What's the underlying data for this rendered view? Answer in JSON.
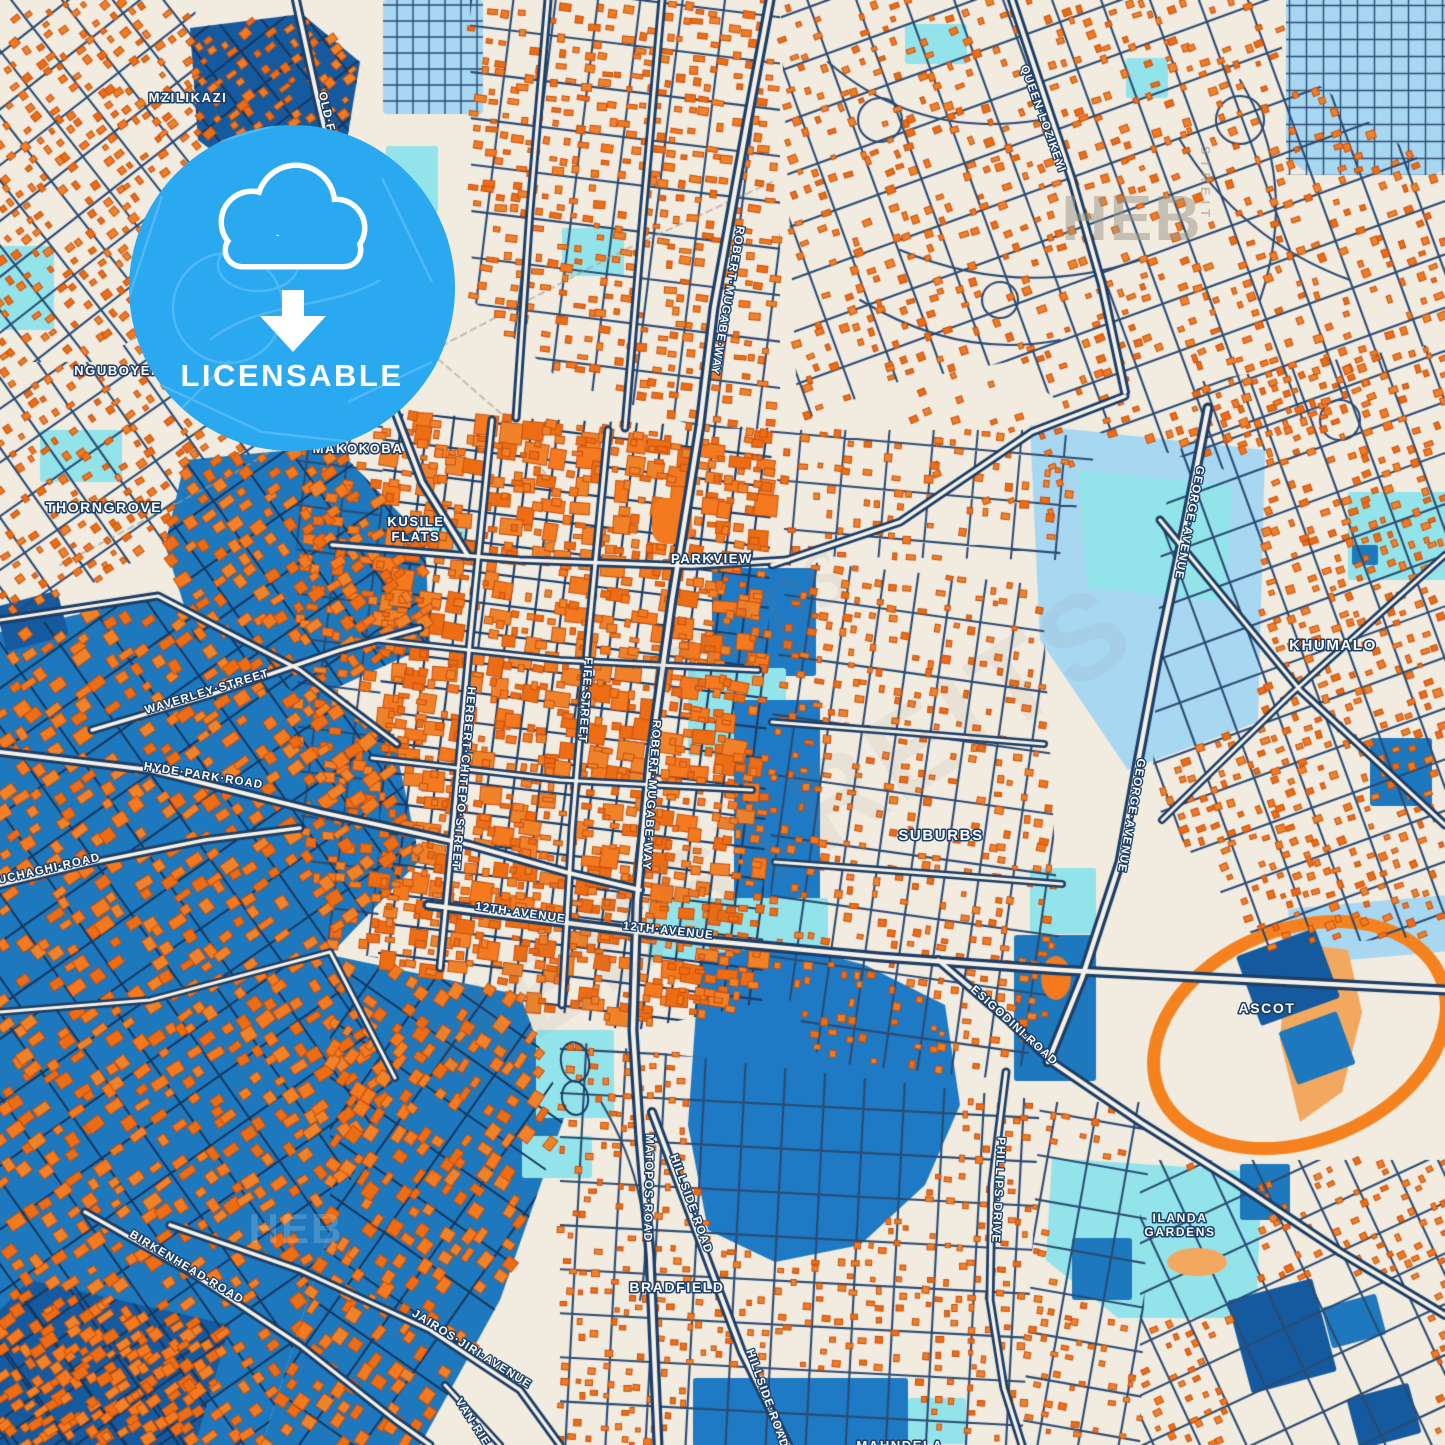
{
  "badge": {
    "label": "LICENSABLE",
    "inner_place_line1": "BARBOUR",
    "inner_place_line2": "FIELDS",
    "icon": "cloud-download-icon",
    "color": "#2aa9f1",
    "cx": 292,
    "cy": 288,
    "r": 163
  },
  "colors": {
    "background": "#f1ebe0",
    "building_fill": "#f4791f",
    "building_alt": "#ed6d15",
    "building_alt2": "#f0832a",
    "building_edge": "#c7500f",
    "industrial_blue": "#1d78bd",
    "dark_blue_zone": "#155a9e",
    "lake_blue": "#1e7ac4",
    "park_cyan": "#93e4ea",
    "pale_blue": "#a8d7f2",
    "road_navy": "#1c3e67",
    "road_fill": "#f6f1e6",
    "minor_road": "#2b4b73",
    "minor_road_dark": "#16375f",
    "racetrack_orange": "#f5821f",
    "sand_orange": "#f3a860",
    "railway_gray": "#a89f8f",
    "badge_blue": "#2aa9f1",
    "label_white": "#ffffff",
    "watermark_gray": "#9c9588"
  },
  "place_labels": [
    {
      "text": "MZILIKAZI",
      "x": 188,
      "y": 102,
      "size": 13
    },
    {
      "text": "NGUBOYENJA",
      "x": 128,
      "y": 375,
      "size": 13
    },
    {
      "text": "THORNGROVE",
      "x": 104,
      "y": 512,
      "size": 14
    },
    {
      "text": "MAKOKOBA",
      "x": 358,
      "y": 453,
      "size": 13
    },
    {
      "text": "KUSILE",
      "x": 416,
      "y": 526,
      "size": 13,
      "line2": "FLATS"
    },
    {
      "text": "PARKVIEW",
      "x": 712,
      "y": 563,
      "size": 13
    },
    {
      "text": "SUBURBS",
      "x": 941,
      "y": 840,
      "size": 15
    },
    {
      "text": "KHUMALO",
      "x": 1333,
      "y": 650,
      "size": 15
    },
    {
      "text": "ASCOT",
      "x": 1267,
      "y": 1013,
      "size": 14
    },
    {
      "text": "ILANDA",
      "x": 1180,
      "y": 1222,
      "size": 12,
      "line2": "GARDENS"
    },
    {
      "text": "BRADFIELD",
      "x": 677,
      "y": 1292,
      "size": 14
    },
    {
      "text": "MAHNDELA",
      "x": 900,
      "y": 1450,
      "size": 13
    }
  ],
  "street_labels": [
    {
      "text": "OLD·FALLS·ROAD",
      "x": 332,
      "y": 150,
      "rot": 77
    },
    {
      "text": "QUEEN·LOZIKEYI",
      "x": 1040,
      "y": 120,
      "rot": 70
    },
    {
      "text": "ROBERT·MUGABE·WAY",
      "x": 724,
      "y": 300,
      "rot": 100
    },
    {
      "text": "ROBERT·MUGABE·WAY",
      "x": 648,
      "y": 795,
      "rot": 94
    },
    {
      "text": "FIFE·STREET",
      "x": 582,
      "y": 700,
      "rot": 94
    },
    {
      "text": "HERBERT·CHITEPO·STREET",
      "x": 460,
      "y": 778,
      "rot": 95
    },
    {
      "text": "GEORGE·AVENUE",
      "x": 1186,
      "y": 522,
      "rot": 101
    },
    {
      "text": "GEORGE·AVENUE",
      "x": 1128,
      "y": 815,
      "rot": 100
    },
    {
      "text": "WAVERLEY·STREET",
      "x": 208,
      "y": 695,
      "rot": -17
    },
    {
      "text": "HYDE·PARK·ROAD",
      "x": 203,
      "y": 779,
      "rot": 9
    },
    {
      "text": "UCHAGHI·ROAD",
      "x": 50,
      "y": 872,
      "rot": -13
    },
    {
      "text": "12TH·AVENUE",
      "x": 520,
      "y": 916,
      "rot": 8
    },
    {
      "text": "12TH·AVENUE",
      "x": 668,
      "y": 934,
      "rot": 6
    },
    {
      "text": "ESIGODINI·ROAD",
      "x": 1012,
      "y": 1028,
      "rot": 42
    },
    {
      "text": "PHILLIPS·DRIVE",
      "x": 995,
      "y": 1190,
      "rot": 93
    },
    {
      "text": "MATOPOS·ROAD",
      "x": 645,
      "y": 1188,
      "rot": 91
    },
    {
      "text": "HILLSIDE·ROAD",
      "x": 688,
      "y": 1205,
      "rot": 70
    },
    {
      "text": "HILLSIDE·ROAD",
      "x": 764,
      "y": 1400,
      "rot": 70
    },
    {
      "text": "JAIROS·JIRI·AVENUE",
      "x": 470,
      "y": 1352,
      "rot": 32
    },
    {
      "text": "BIRKENHEAD·ROAD",
      "x": 185,
      "y": 1270,
      "rot": 31
    },
    {
      "text": "VAN·RIE",
      "x": 470,
      "y": 1424,
      "rot": 57
    }
  ],
  "watermarks": [
    {
      "text": "HEB",
      "x": 1132,
      "y": 240,
      "size": 64,
      "rot": 0,
      "opacity": 0.5,
      "ls": 2,
      "color": "#9c9588",
      "italic": false
    },
    {
      "text": "STREIT",
      "x": 1201,
      "y": 184,
      "size": 13,
      "rot": 90,
      "opacity": 0.55,
      "ls": 5,
      "color": "#9c9588",
      "italic": false
    },
    {
      "text": "maps",
      "x": 762,
      "y": 648,
      "size": 104,
      "rot": -33,
      "opacity": 0.1,
      "ls": 0,
      "color": "#7d786c",
      "italic": true
    },
    {
      "text": "HEBSTREITS",
      "x": 800,
      "y": 870,
      "size": 120,
      "rot": -33,
      "opacity": 0.08,
      "ls": 6,
      "color": "#7d786c",
      "italic": false
    },
    {
      "text": "HEB",
      "x": 296,
      "y": 1243,
      "size": 42,
      "rot": 0,
      "opacity": 0.18,
      "ls": 2,
      "color": "#ffffff",
      "italic": false
    }
  ]
}
